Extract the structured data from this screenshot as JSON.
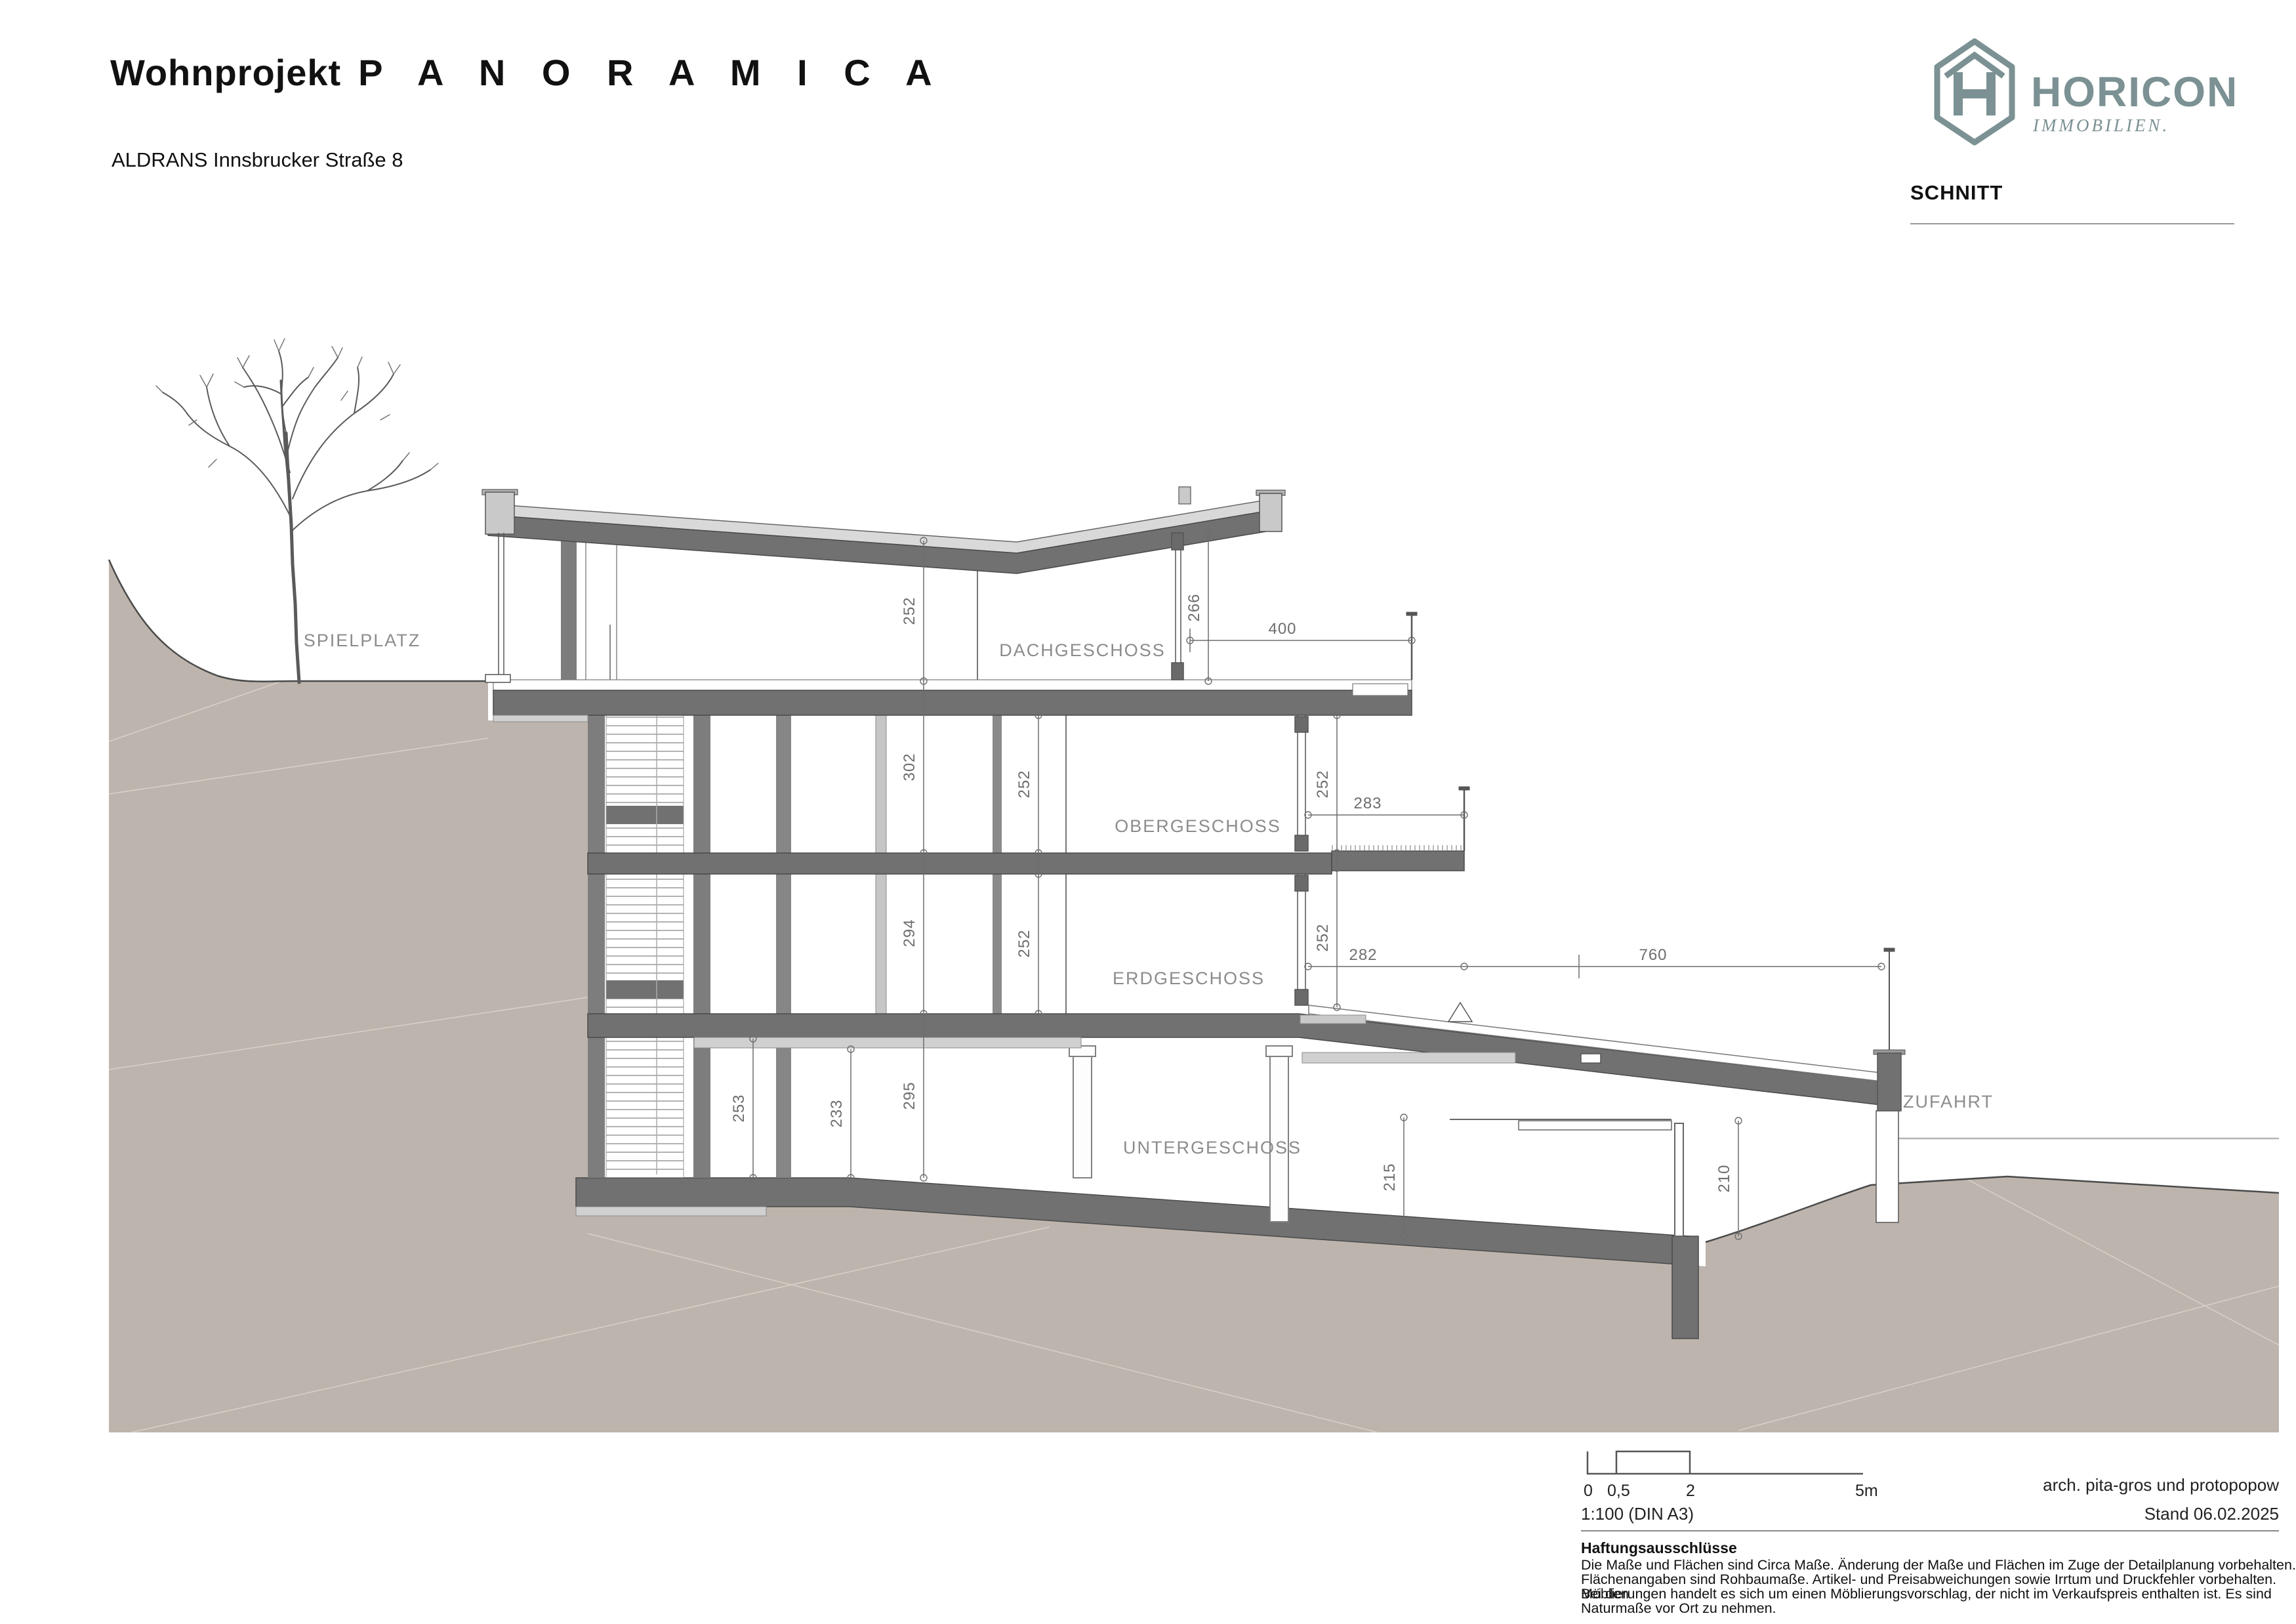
{
  "header": {
    "project_type": "Wohnprojekt",
    "project_name": "P A N O R A M I C A",
    "subtitle": "ALDRANS Innsbrucker Straße 8"
  },
  "logo": {
    "name": "HORICON",
    "tagline": "IMMOBILIEN.",
    "color": "#7b9193"
  },
  "sheet": {
    "label": "SCHNITT"
  },
  "drawing": {
    "room_labels": [
      {
        "text": "SPIELPLATZ"
      },
      {
        "text": "DACHGESCHOSS"
      },
      {
        "text": "OBERGESCHOSS"
      },
      {
        "text": "ERDGESCHOSS"
      },
      {
        "text": "UNTERGESCHOSS"
      },
      {
        "text": "ZUFAHRT"
      }
    ],
    "dims": [
      {
        "value": "252",
        "where": "dachgeschoss-height"
      },
      {
        "value": "266",
        "where": "dachgeschoss-terrace-height"
      },
      {
        "value": "400",
        "where": "dachgeschoss-terrace-width"
      },
      {
        "value": "302",
        "where": "dg-og-storey"
      },
      {
        "value": "252",
        "where": "obergeschoss-height-left"
      },
      {
        "value": "252",
        "where": "obergeschoss-height-right"
      },
      {
        "value": "283",
        "where": "og-balcony-width"
      },
      {
        "value": "294",
        "where": "og-eg-storey"
      },
      {
        "value": "252",
        "where": "erdgeschoss-height-left"
      },
      {
        "value": "252",
        "where": "erdgeschoss-height-right"
      },
      {
        "value": "282",
        "where": "eg-terrace-width-1"
      },
      {
        "value": "760",
        "where": "eg-terrace-width-2"
      },
      {
        "value": "253",
        "where": "untergeschoss-height-1"
      },
      {
        "value": "233",
        "where": "untergeschoss-height-2"
      },
      {
        "value": "295",
        "where": "eg-ug-storey"
      },
      {
        "value": "215",
        "where": "garage-clear-height"
      },
      {
        "value": "210",
        "where": "garage-door-height"
      }
    ],
    "colors": {
      "terrain": "#bdb5ad",
      "slab": "#717171",
      "light_gray": "#c9c9c9",
      "line": "#4a4a4a"
    }
  },
  "footer": {
    "scale_ticks": [
      "0",
      "0,5",
      "2",
      "5m"
    ],
    "architect": "arch. pita-gros und protopopow",
    "scale_note": "1:100 (DIN A3)",
    "date": "Stand 06.02.2025",
    "disclaimer_title": "Haftungsausschlüsse",
    "disclaimer_lines": [
      "Die Maße und Flächen sind Circa Maße. Änderung der Maße und Flächen im Zuge der Detailplanung vorbehalten.",
      "Flächenangaben sind Rohbaumaße. Artikel- und Preisabweichungen sowie Irrtum und Druckfehler vorbehalten. Bei den",
      "Möblierungen handelt es sich um einen Möblierungsvorschlag, der nicht im Verkaufspreis enthalten ist. Es sind",
      "Naturmaße vor Ort zu nehmen."
    ]
  }
}
